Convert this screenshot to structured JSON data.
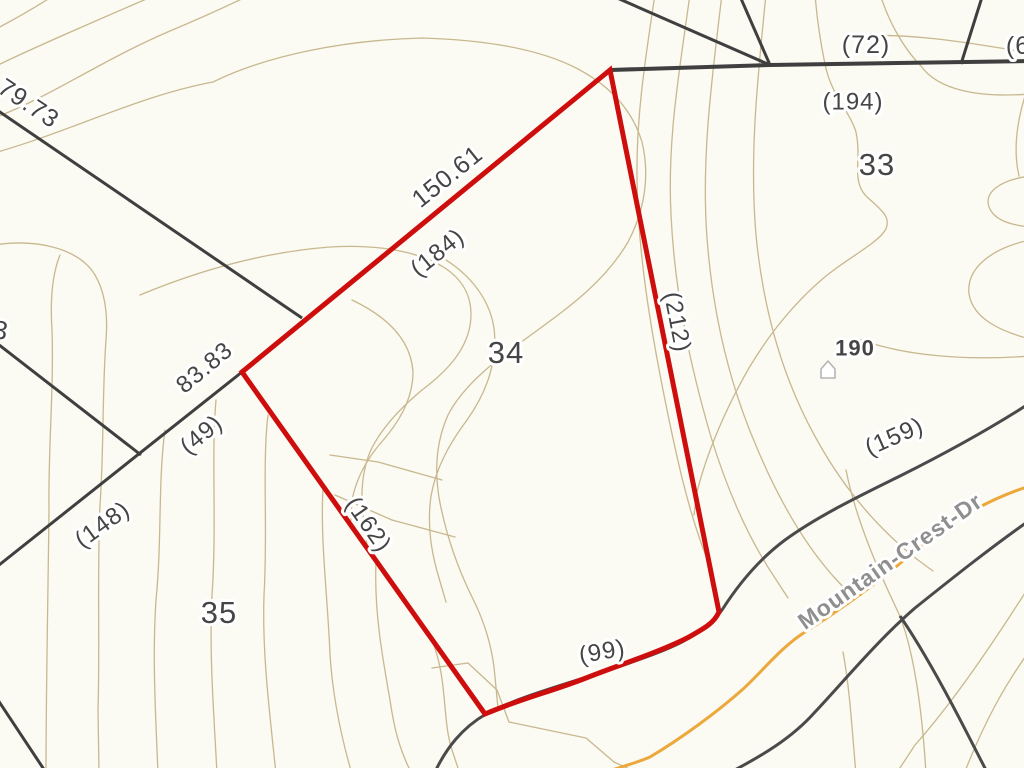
{
  "map": {
    "type": "parcel-contour-map",
    "colors": {
      "bg": "#FBFAF3",
      "highlight": "#CE0D0D",
      "boundary": "#3F3F3F",
      "roadedge": "#4A4A4A",
      "centerline": "#EDA83B",
      "contour": "#C8B88E",
      "label": "#454545",
      "roadtext": "#8F8F8F",
      "building": "#B5B5B5",
      "halo": "#FFFFFF"
    },
    "parcels": {
      "highlighted": "34",
      "visible_numbers": [
        "33",
        "34",
        "35"
      ]
    },
    "road": {
      "name": "Mountain-Crest-Dr"
    },
    "building_marker": {
      "icon": "house-icon",
      "address_label": "190",
      "x": 828,
      "y": 369
    },
    "labels": [
      {
        "id": "dim-79-73",
        "text": "79.73",
        "x": 29,
        "y": 103,
        "rot": 34,
        "size": 25,
        "bold": false,
        "color": "label"
      },
      {
        "id": "dim-150-61",
        "text": "150.61",
        "x": 447,
        "y": 176,
        "rot": -39,
        "size": 25,
        "bold": false,
        "color": "label"
      },
      {
        "id": "dim-184",
        "text": "(184)",
        "x": 437,
        "y": 252,
        "rot": -39,
        "size": 24,
        "bold": false,
        "color": "label"
      },
      {
        "id": "parcel-34",
        "text": "34",
        "x": 506,
        "y": 352,
        "rot": 0,
        "size": 31,
        "bold": false,
        "color": "label"
      },
      {
        "id": "dim-212",
        "text": "(212)",
        "x": 678,
        "y": 322,
        "rot": 79,
        "size": 24,
        "bold": false,
        "color": "label"
      },
      {
        "id": "dim-72",
        "text": "(72)",
        "x": 866,
        "y": 44,
        "rot": 0,
        "size": 25,
        "bold": false,
        "color": "label"
      },
      {
        "id": "dim-6-clipped",
        "text": "(6",
        "x": 1018,
        "y": 45,
        "rot": 0,
        "size": 25,
        "bold": false,
        "color": "label"
      },
      {
        "id": "dim-194",
        "text": "(194)",
        "x": 853,
        "y": 101,
        "rot": 0,
        "size": 24,
        "bold": false,
        "color": "label"
      },
      {
        "id": "parcel-33",
        "text": "33",
        "x": 877,
        "y": 164,
        "rot": 0,
        "size": 31,
        "bold": false,
        "color": "label"
      },
      {
        "id": "address-190",
        "text": "190",
        "x": 855,
        "y": 348,
        "rot": 0,
        "size": 22,
        "bold": true,
        "color": "label"
      },
      {
        "id": "dim-159",
        "text": "(159)",
        "x": 894,
        "y": 436,
        "rot": -24,
        "size": 24,
        "bold": false,
        "color": "label"
      },
      {
        "id": "road-name",
        "text": "Mountain-Crest-Dr",
        "x": 890,
        "y": 561,
        "rot": -35,
        "size": 23,
        "bold": true,
        "color": "road"
      },
      {
        "id": "dim-99",
        "text": "(99)",
        "x": 602,
        "y": 651,
        "rot": -10,
        "size": 24,
        "bold": false,
        "color": "label"
      },
      {
        "id": "dim-162",
        "text": "(162)",
        "x": 369,
        "y": 524,
        "rot": 55,
        "size": 24,
        "bold": false,
        "color": "label"
      },
      {
        "id": "dim-83-83",
        "text": "83.83",
        "x": 204,
        "y": 367,
        "rot": -40,
        "size": 24,
        "bold": false,
        "color": "label"
      },
      {
        "id": "dim-49",
        "text": "(49)",
        "x": 201,
        "y": 434,
        "rot": -40,
        "size": 24,
        "bold": false,
        "color": "label"
      },
      {
        "id": "dim-148",
        "text": "(148)",
        "x": 102,
        "y": 524,
        "rot": -36,
        "size": 24,
        "bold": false,
        "color": "label"
      },
      {
        "id": "parcel-35",
        "text": "35",
        "x": 219,
        "y": 612,
        "rot": 0,
        "size": 31,
        "bold": false,
        "color": "label"
      },
      {
        "id": "digit-3-clipped",
        "text": "3",
        "x": 1,
        "y": 330,
        "rot": 10,
        "size": 26,
        "bold": false,
        "color": "label"
      }
    ]
  }
}
